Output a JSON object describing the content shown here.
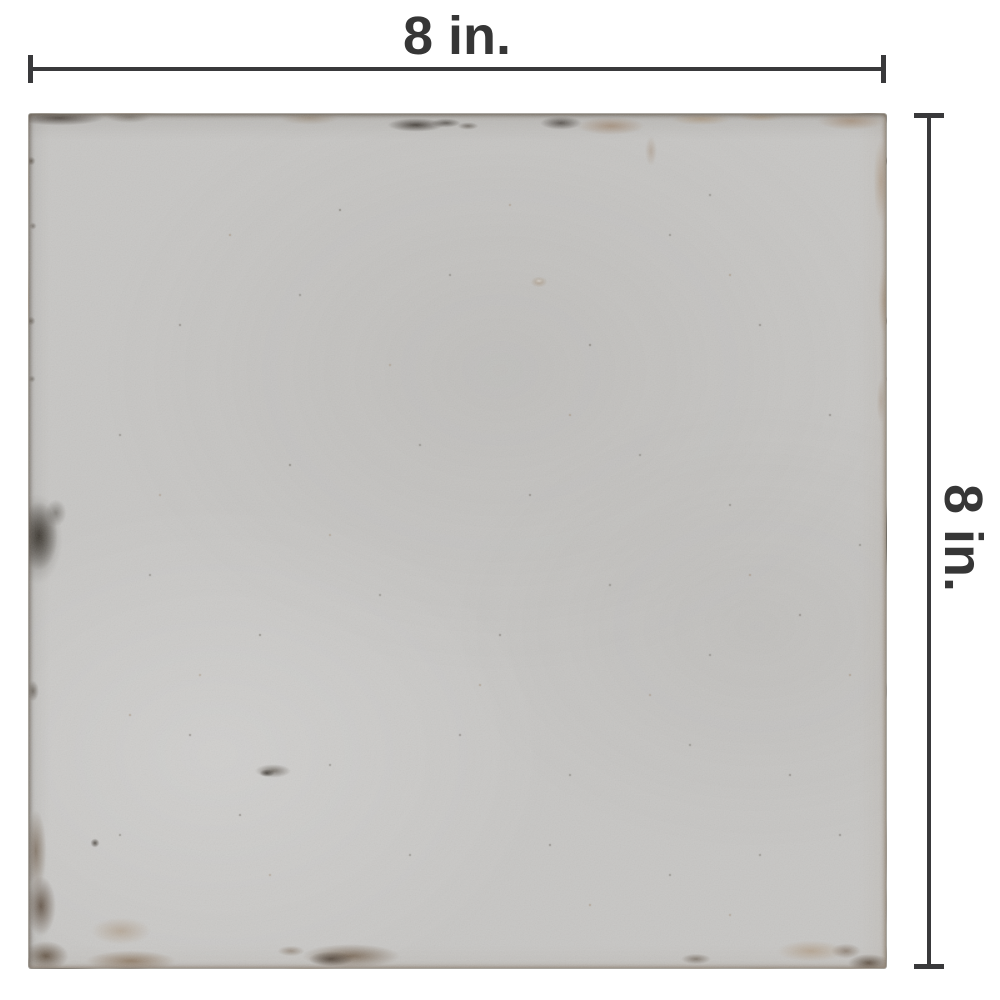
{
  "figure": {
    "subject": "distressed gray square tile product photo with dimension annotations",
    "width_label": "8 in.",
    "height_label": "8 in."
  },
  "colors": {
    "background": "#ffffff",
    "dimension_line": "#39393b",
    "label_text": "#363636",
    "tile_base": "#c7c6c4",
    "tile_distress_dark": "#4a453e",
    "tile_distress_brown": "#8a7154",
    "tile_distress_tan": "#b3987b"
  }
}
